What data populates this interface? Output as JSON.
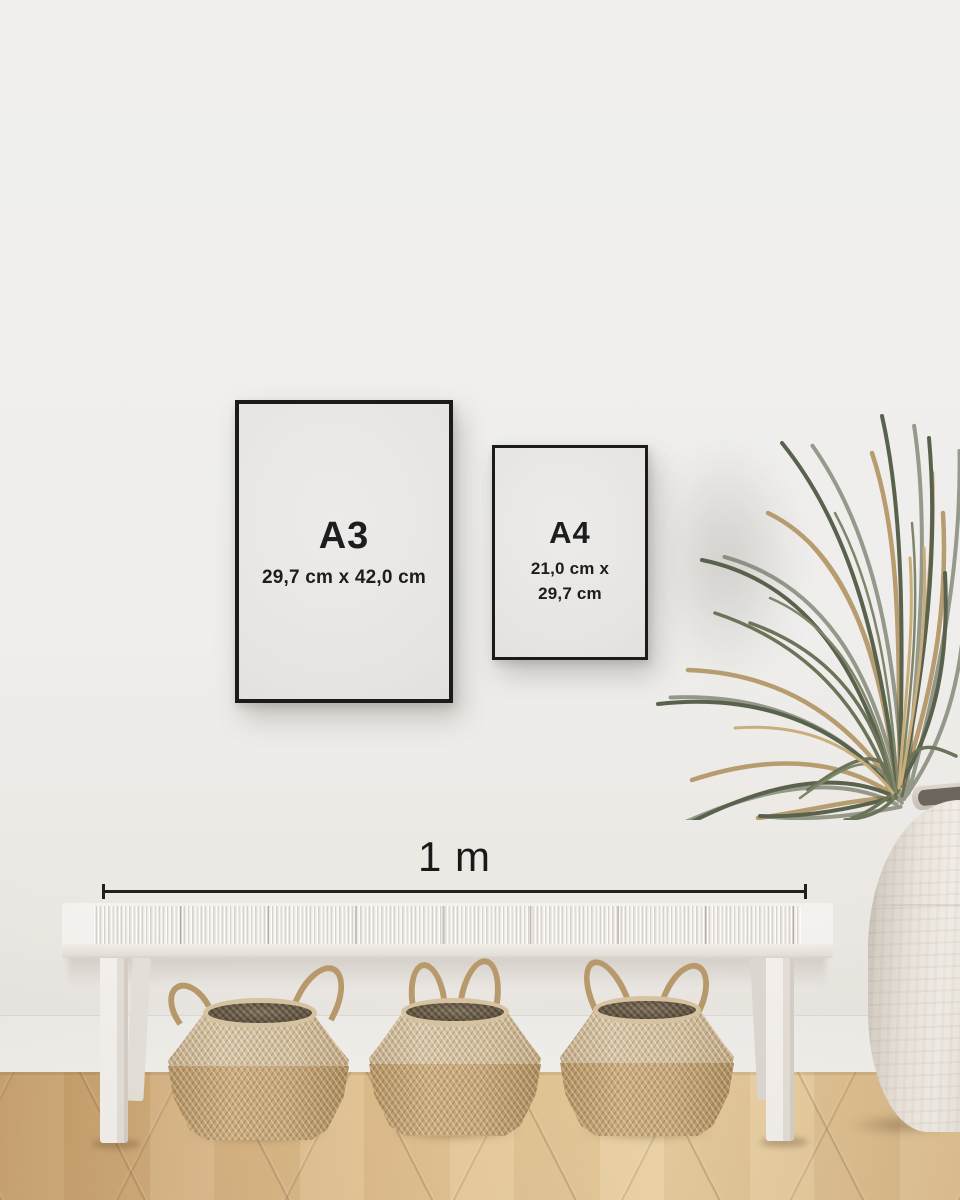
{
  "frames": [
    {
      "id": "a3",
      "label": "A3",
      "dimensions": "29,7 cm x 42,0 cm"
    },
    {
      "id": "a4",
      "label": "A4",
      "dimensions_line1": "21,0 cm x",
      "dimensions_line2": "29,7 cm"
    }
  ],
  "scale_bar": {
    "label": "1 m"
  },
  "scene_objects": [
    "A3 black poster frame",
    "A4 black poster frame",
    "1 m scale measuring line",
    "white woven bench",
    "three seagrass belly baskets",
    "dried palm plant in white ceramic urn",
    "oak chevron parquet floor"
  ],
  "colors": {
    "wall": "#efeeec",
    "frame_border": "#1b1b1b",
    "paper": "#e7e5e3",
    "label_text": "#1d1d1d",
    "scale_line": "#202020",
    "floor": "#e0bd8b",
    "basket_light": "#d6c3a1",
    "basket_dark": "#c2a172",
    "bench": "#f4f2ee",
    "vase": "#eae4dc",
    "plant_green": "#67705a",
    "plant_tan": "#b59869"
  }
}
